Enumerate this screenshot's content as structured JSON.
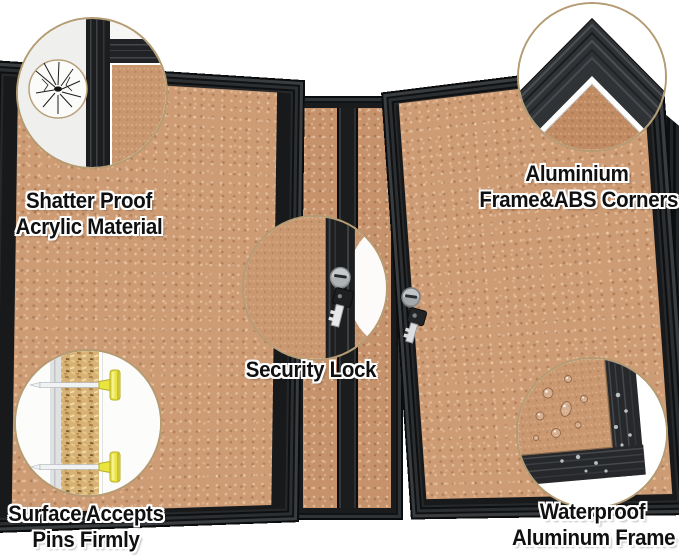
{
  "callouts": {
    "shatter": {
      "line1": "Shatter Proof",
      "line2": "Acrylic Material"
    },
    "aluminium": {
      "line1": "Aluminium",
      "line2": "Frame&ABS Corners"
    },
    "lock": {
      "line1": "Security Lock"
    },
    "pins": {
      "line1": "Surface Accepts",
      "line2": "Pins Firmly"
    },
    "waterproof": {
      "line1": "Waterproof",
      "line2": "Aluminum Frame"
    }
  },
  "icons": {
    "shatter_crack": "shatter-crack-icon",
    "frame_corner": "frame-corner-icon",
    "security_lock": "security-lock-icon",
    "push_pins": "push-pins-icon",
    "water_drops": "water-drops-icon"
  },
  "colors": {
    "background": "#ffffff",
    "cork": "#cd9b74",
    "frame_black": "#1a1c1e",
    "circle_border": "#b49b72",
    "pin_yellow": "#e9e33c",
    "label_text": "#101010",
    "label_outline": "#ffffff"
  }
}
